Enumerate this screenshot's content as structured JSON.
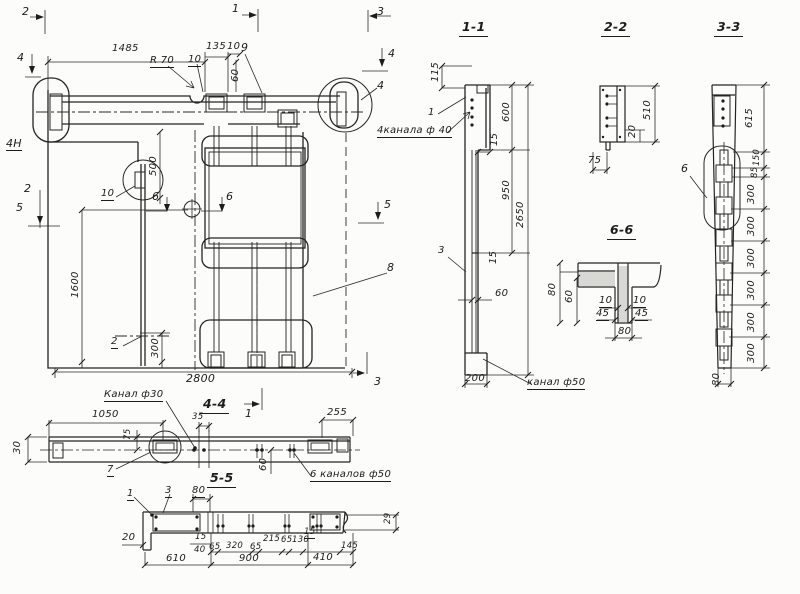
{
  "plan": {
    "marker_2_top": "2",
    "marker_1_top": "1",
    "marker_3_top": "3",
    "marker_4_left": "4",
    "marker_4_right": "4",
    "marker_2_left": "2",
    "marker_5_left": "5",
    "marker_5_right": "5",
    "marker_6_a": "6",
    "marker_6_b": "6",
    "marker_3_bottom": "3",
    "marker_1_bottom": "1",
    "dim_1485": "1485",
    "dim_135": "135",
    "dim_10_a": "10",
    "dim_10_b": "10",
    "dim_60": "60",
    "dim_500": "500",
    "dim_1600": "1600",
    "dim_300": "300",
    "dim_2800": "2800",
    "radius_note": "R 70",
    "pos_9": "9",
    "pos_10": "10",
    "pos_4": "4",
    "pos_2": "2",
    "pos_8": "8",
    "mark_4n": "4Н"
  },
  "sec11": {
    "title": "1-1",
    "dim_115": "115",
    "pos_1": "1",
    "note_4ch40": "4канала ф 40",
    "dim_600": "600",
    "dim_15_top": "15",
    "dim_950": "950",
    "dim_2650": "2650",
    "pos_3": "3",
    "dim_15_mid": "15",
    "dim_60": "60",
    "dim_200": "200",
    "note_ch50": "канал ф50"
  },
  "sec22": {
    "title": "2-2",
    "dim_510": "510",
    "dim_20": "20",
    "dim_75": "75"
  },
  "sec33": {
    "title": "3-3",
    "pos_6": "6",
    "dim_615": "615",
    "dim_150": "150",
    "dim_85": "85",
    "dim_300_1": "300",
    "dim_300_2": "300",
    "dim_300_3": "300",
    "dim_300_4": "300",
    "dim_300_5": "300",
    "dim_300_6": "300",
    "dim_80": "80"
  },
  "sec66": {
    "title": "6-6",
    "dim_80_left": "80",
    "dim_60": "60",
    "dim_10_l": "10",
    "dim_10_r": "10",
    "dim_45_l": "45",
    "dim_45_r": "45",
    "dim_80_bottom": "80"
  },
  "side": {
    "note_ch30": "Канал ф30",
    "dim_1050": "1050",
    "dim_75": "75",
    "dim_30": "30",
    "pos_7": "7",
    "title_44": "4-4",
    "dim_35": "35",
    "dim_255": "255",
    "dim_60": "60",
    "note_6ch50": "6 каналов ф50"
  },
  "sec55": {
    "title": "5-5",
    "dim_80": "80",
    "pos_1": "1",
    "pos_3": "3",
    "dim_20": "20",
    "dim_15_a": "15",
    "dim_40": "40",
    "dim_65_a": "65",
    "dim_320": "320",
    "dim_65_b": "65",
    "dim_215": "215",
    "dim_65_c": "65",
    "dim_130": "130",
    "dim_15_b": "15",
    "dim_145": "145",
    "dim_29": "29",
    "dim_610": "610",
    "dim_900": "900",
    "dim_410": "410"
  }
}
